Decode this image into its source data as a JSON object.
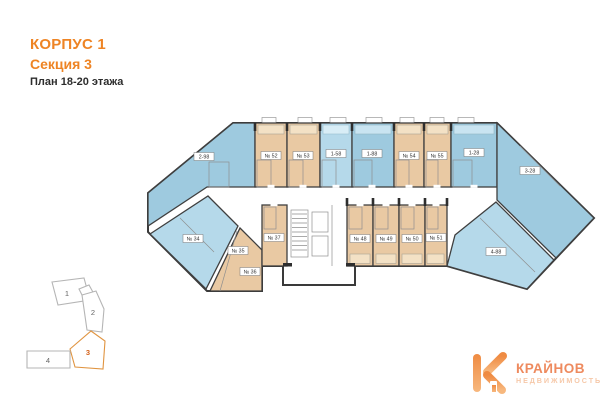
{
  "header": {
    "building": "КОРПУС 1",
    "section": "Секция 3",
    "floors": "План 18-20 этажа"
  },
  "plan": {
    "unit_labels": {
      "w1": "2-98",
      "w2": "№ 34",
      "b1": "№ 35",
      "b2": "№ 36",
      "c0": "№ 37",
      "t1": "№ 52",
      "t2": "№ 53",
      "t3": "1-58",
      "t4": "1-88",
      "t5": "№ 54",
      "t6": "№ 55",
      "t7": "1-28",
      "r1": "3-28",
      "r2": "4-88",
      "c1": "№ 48",
      "c2": "№ 49",
      "c3": "№ 50",
      "c4": "№ 51"
    }
  },
  "minimap": {
    "sections": [
      {
        "label": "1",
        "highlighted": false
      },
      {
        "label": "2",
        "highlighted": false
      },
      {
        "label": "3",
        "highlighted": true
      },
      {
        "label": "4",
        "highlighted": false
      }
    ]
  },
  "logo": {
    "name": "КРАЙНОВ",
    "subtitle": "НЕДВИЖИМОСТЬ"
  },
  "colors": {
    "accent_orange": "#ee8424",
    "unit_blue": "#9ecadf",
    "unit_blue_light": "#b5d9ea",
    "unit_beige": "#e9c9a3",
    "minimap_highlight": "#f2a64f",
    "logo_coral": "#ee8a5e",
    "logo_coral_light": "#f6c8a8"
  }
}
